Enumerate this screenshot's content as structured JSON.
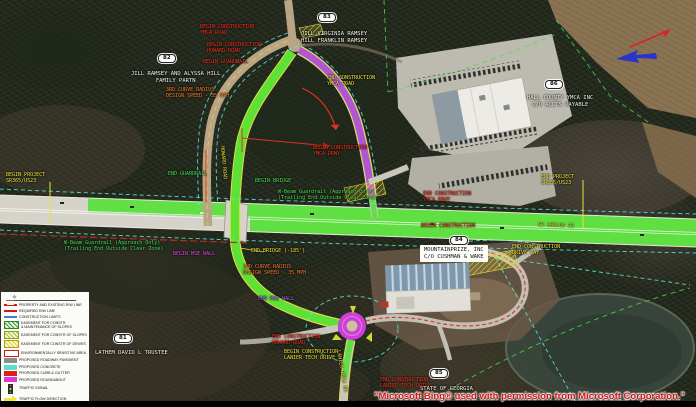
{
  "map": {
    "description": "Roadway construction plan over aerial imagery, SR 365/US 23 interchange with YMCA Road, Howard Road and Lanier Tech Drive roundabout",
    "credit": "\"Microsoft Bing® used with permission from Microsoft Corporation.\""
  },
  "colors": {
    "label_red": "#ff3320",
    "label_yellow": "#f0e63c",
    "label_green": "#48e455",
    "label_magenta": "#ee46ee",
    "label_purple": "#b06cf2",
    "label_orange": "#ff7c30",
    "label_white": "#f5f4ee",
    "road_green": "#55e036",
    "roundabout_magenta": "#cf3ed8",
    "limits_cyan": "#5fe8d5",
    "property_green": "#46e046",
    "credit_red": "#d41414"
  },
  "labels": [
    {
      "name": "begin-construction-ymca-road",
      "text": "BEGIN CONSTRUCTION\nYMCA ROAD",
      "x": 200,
      "y": 25,
      "color": "red"
    },
    {
      "name": "begin-construction-howard-road",
      "text": "BEGIN CONSTRUCTION\nHOWARD ROAD",
      "x": 207,
      "y": 43,
      "color": "red"
    },
    {
      "name": "begin-guardrail",
      "text": "BEGIN GUARDRAIL",
      "x": 203,
      "y": 60,
      "color": "red"
    },
    {
      "name": "curve-data-3rd",
      "text": "3RD CURVE RADIUS\nDESIGN SPEED - 35 MPH",
      "x": 166,
      "y": 88,
      "color": "orange"
    },
    {
      "name": "end-construction-ymca-road",
      "text": "END CONSTRUCTION\nYMCA ROAD",
      "x": 327,
      "y": 76,
      "color": "yellow"
    },
    {
      "name": "begin-project-sr365",
      "text": "BEGIN PROJECT\nSR365/US23",
      "x": 6,
      "y": 173,
      "color": "yellow"
    },
    {
      "name": "end-guardrail",
      "text": "END GUARDRAIL",
      "x": 168,
      "y": 172,
      "color": "green"
    },
    {
      "name": "begin-bridge",
      "text": "BEGIN BRIDGE",
      "x": 255,
      "y": 179,
      "color": "green"
    },
    {
      "name": "begin-construction-ymca-drwy",
      "text": "BEGIN CONSTRUCTION\nYMCA DRWY",
      "x": 313,
      "y": 146,
      "color": "red"
    },
    {
      "name": "end-construction-ymca-drwy",
      "text": "END CONSTRUCTION\nYMCA DRWY",
      "x": 423,
      "y": 192,
      "color": "red"
    },
    {
      "name": "guardrail-note-east",
      "text": "W-Beam Guardrail (Approach Only)\n(Trailing End Outside Clear Zone)",
      "x": 278,
      "y": 190,
      "color": "green"
    },
    {
      "name": "guardrail-note-west",
      "text": "W-Beam Guardrail (Approach Only)\n(Trailing End Outside Clear Zone)",
      "x": 64,
      "y": 241,
      "color": "green"
    },
    {
      "name": "end-project-sr365",
      "text": "END PROJECT\nSR365/US23",
      "x": 541,
      "y": 175,
      "color": "yellow"
    },
    {
      "name": "begin-construction-mainline",
      "text": "BEGIN CONSTRUCTION",
      "x": 421,
      "y": 224,
      "color": "red"
    },
    {
      "name": "route-label-sr365",
      "text": "SR 365/US 23",
      "x": 538,
      "y": 223,
      "color": "yellow",
      "rotate": 2
    },
    {
      "name": "end-construction-drive-way",
      "text": "END CONSTRUCTION\nDRIVE WAY",
      "x": 512,
      "y": 245,
      "color": "yellow"
    },
    {
      "name": "begin-mse-wall",
      "text": "BEGIN MSE WALL",
      "x": 173,
      "y": 252,
      "color": "magenta"
    },
    {
      "name": "end-bridge",
      "text": "END BRIDGE (-185')",
      "x": 251,
      "y": 249,
      "color": "yellow"
    },
    {
      "name": "curve-data-2nd",
      "text": "2ND CURVE RADIUS\nDESIGN SPEED - 35 MPH",
      "x": 243,
      "y": 265,
      "color": "orange"
    },
    {
      "name": "end-mse-wall",
      "text": "END MSE WALL",
      "x": 258,
      "y": 297,
      "color": "purple"
    },
    {
      "name": "end-construction-howard-road",
      "text": "END CONSTRUCTION\nHOWARD ROAD",
      "x": 272,
      "y": 335,
      "color": "red"
    },
    {
      "name": "begin-construction-lanier-tech",
      "text": "BEGIN CONSTRUCTION\nLANIER TECH DRIVE",
      "x": 284,
      "y": 350,
      "color": "yellow"
    },
    {
      "name": "end-construction-lanier-tech",
      "text": "END CONSTRUCTION\nLANIER TECH DRIVE",
      "x": 380,
      "y": 378,
      "color": "red"
    },
    {
      "name": "road-name-howard",
      "text": "HOWARD ROAD",
      "x": 224,
      "y": 146,
      "color": "yellow",
      "rotate": 85
    },
    {
      "name": "road-name-lanier-tech",
      "text": "LANIER TECH DR",
      "x": 340,
      "y": 350,
      "color": "yellow",
      "rotate": 80
    }
  ],
  "parcels": [
    {
      "id": "83",
      "badge": {
        "x": 318,
        "y": 13
      },
      "owner": {
        "text": "JILL VIRGINIA RAMSEY\nHILL FRANKLIN RAMSEY",
        "x": 301,
        "y": 31
      }
    },
    {
      "id": "82",
      "badge": {
        "x": 158,
        "y": 54
      },
      "owner": {
        "text": "JILL RAMSEY AND ALYSSA HILL\nFAMILY PARTN",
        "x": 131,
        "y": 71
      }
    },
    {
      "id": "86",
      "badge": {
        "x": 545,
        "y": 80
      },
      "owner": {
        "text": "HALL COUNTY YMCA INC\nC/O ACCTS PAYABLE",
        "x": 527,
        "y": 95
      }
    },
    {
      "id": "84",
      "badge": {
        "x": 450,
        "y": 236
      },
      "owner": {
        "text": "MOUNTAINPRIZE, INC\nC/O CUSHMAN & WAKE",
        "x": 420,
        "y": 245
      },
      "boxed": true
    },
    {
      "id": "81",
      "badge": {
        "x": 114,
        "y": 334
      },
      "owner": {
        "text": "LATHEM DAVID L TRUSTEE",
        "x": 95,
        "y": 350
      }
    },
    {
      "id": "85",
      "badge": {
        "x": 430,
        "y": 369
      },
      "owner": {
        "text": "STATE OF GEORGIA",
        "x": 420,
        "y": 386
      }
    }
  ],
  "legend": {
    "items": [
      {
        "swatch": "line-rw",
        "label": "PROPERTY AND EXISTING R/W LINE"
      },
      {
        "swatch": "line-req",
        "label": "REQUIRED R/W LINE"
      },
      {
        "swatch": "line-limits",
        "label": "CONSTRUCTION LIMITS"
      },
      {
        "swatch": "hatch-green",
        "label": "EASEMENT FOR CONSTR\n& MAINTENANCE OF SLOPES"
      },
      {
        "swatch": "hatch-lime",
        "label": "EASEMENT FOR CONSTR OF SLOPES"
      },
      {
        "swatch": "hatch-yellow",
        "label": "EASEMENT FOR CONSTR OF DRIVES"
      },
      {
        "swatch": "box-env",
        "label": "ENVIRONMENTALLY SENSITIVE AREA"
      },
      {
        "swatch": "box-pavement",
        "label": "PROPOSED ROADWAY PAVEMENT"
      },
      {
        "swatch": "box-concrete",
        "label": "PROPOSED CONCRETE"
      },
      {
        "swatch": "box-curb",
        "label": "PROPOSED CURB & GUTTER"
      },
      {
        "swatch": "box-roundabout",
        "label": "PROPOSED ROUNDABOUT"
      },
      {
        "swatch": "signal",
        "label": "TRAFFIC SIGNAL"
      },
      {
        "swatch": "arrow",
        "label": "TRAFFIC FLOW DIRECTION"
      }
    ]
  }
}
